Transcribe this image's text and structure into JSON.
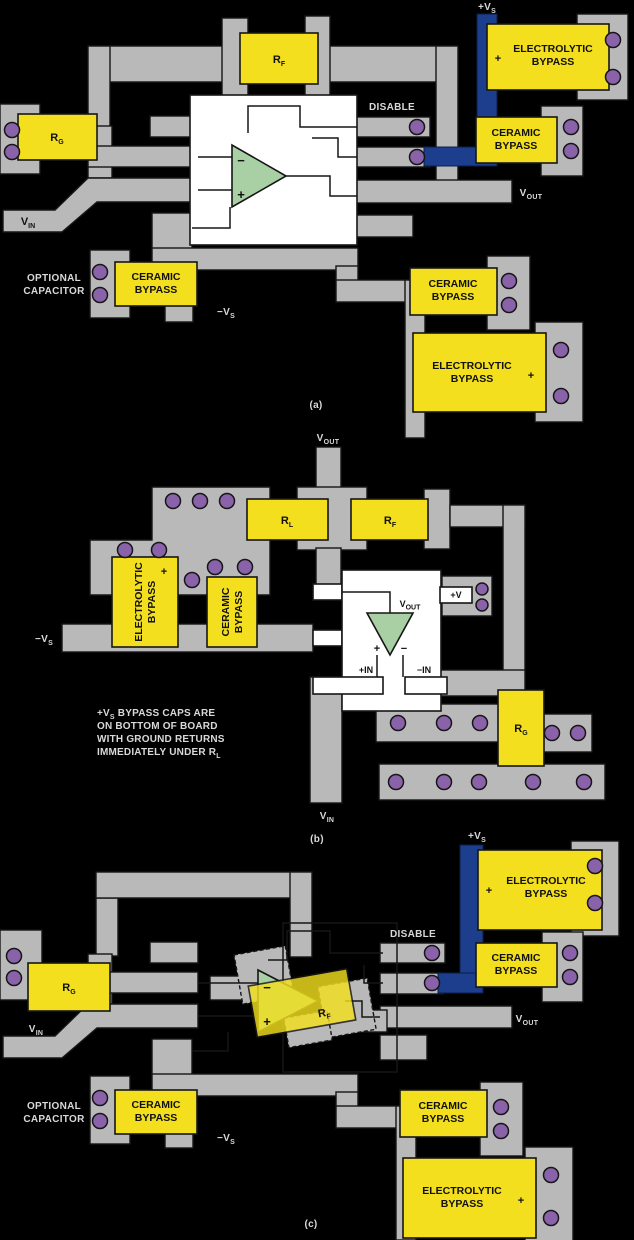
{
  "title": "High-speed op amp PCB bypass layouts",
  "colors": {
    "background": "#000000",
    "copper_trace": "#b9b9b9",
    "component_yellow": "#f3df1d",
    "supply_trace_blue": "#1c3e8c",
    "opamp_green": "#a9cfa5",
    "via_purple": "#8a62aa",
    "ic_body_white": "#ffffff"
  },
  "labels": {
    "vs_pos": {
      "main": "+V",
      "sub": "S"
    },
    "vs_neg": {
      "main": "−V",
      "sub": "S"
    },
    "vin": {
      "main": "V",
      "sub": "IN"
    },
    "vout": {
      "main": "V",
      "sub": "OUT"
    },
    "rf": {
      "main": "R",
      "sub": "F"
    },
    "rg": {
      "main": "R",
      "sub": "G"
    },
    "rl": {
      "main": "R",
      "sub": "L"
    },
    "plus_in": "+IN",
    "minus_in": "−IN",
    "plus_v": "+V",
    "disable": "DISABLE",
    "plus": "+",
    "minus": "−",
    "electrolytic": {
      "l1": "ELECTROLYTIC",
      "l2": "BYPASS"
    },
    "ceramic": {
      "l1": "CERAMIC",
      "l2": "BYPASS"
    },
    "optional": {
      "l1": "OPTIONAL",
      "l2": "CAPACITOR"
    },
    "captions": {
      "a": "(a)",
      "b": "(b)",
      "c": "(c)"
    },
    "note": {
      "l1a": "+V",
      "l1sub": "S",
      "l1b": " BYPASS CAPS ARE",
      "l2": "ON BOTTOM OF BOARD",
      "l3": "WITH GROUND RETURNS",
      "l4a": "IMMEDIATELY UNDER R",
      "l4sub": "L"
    }
  }
}
